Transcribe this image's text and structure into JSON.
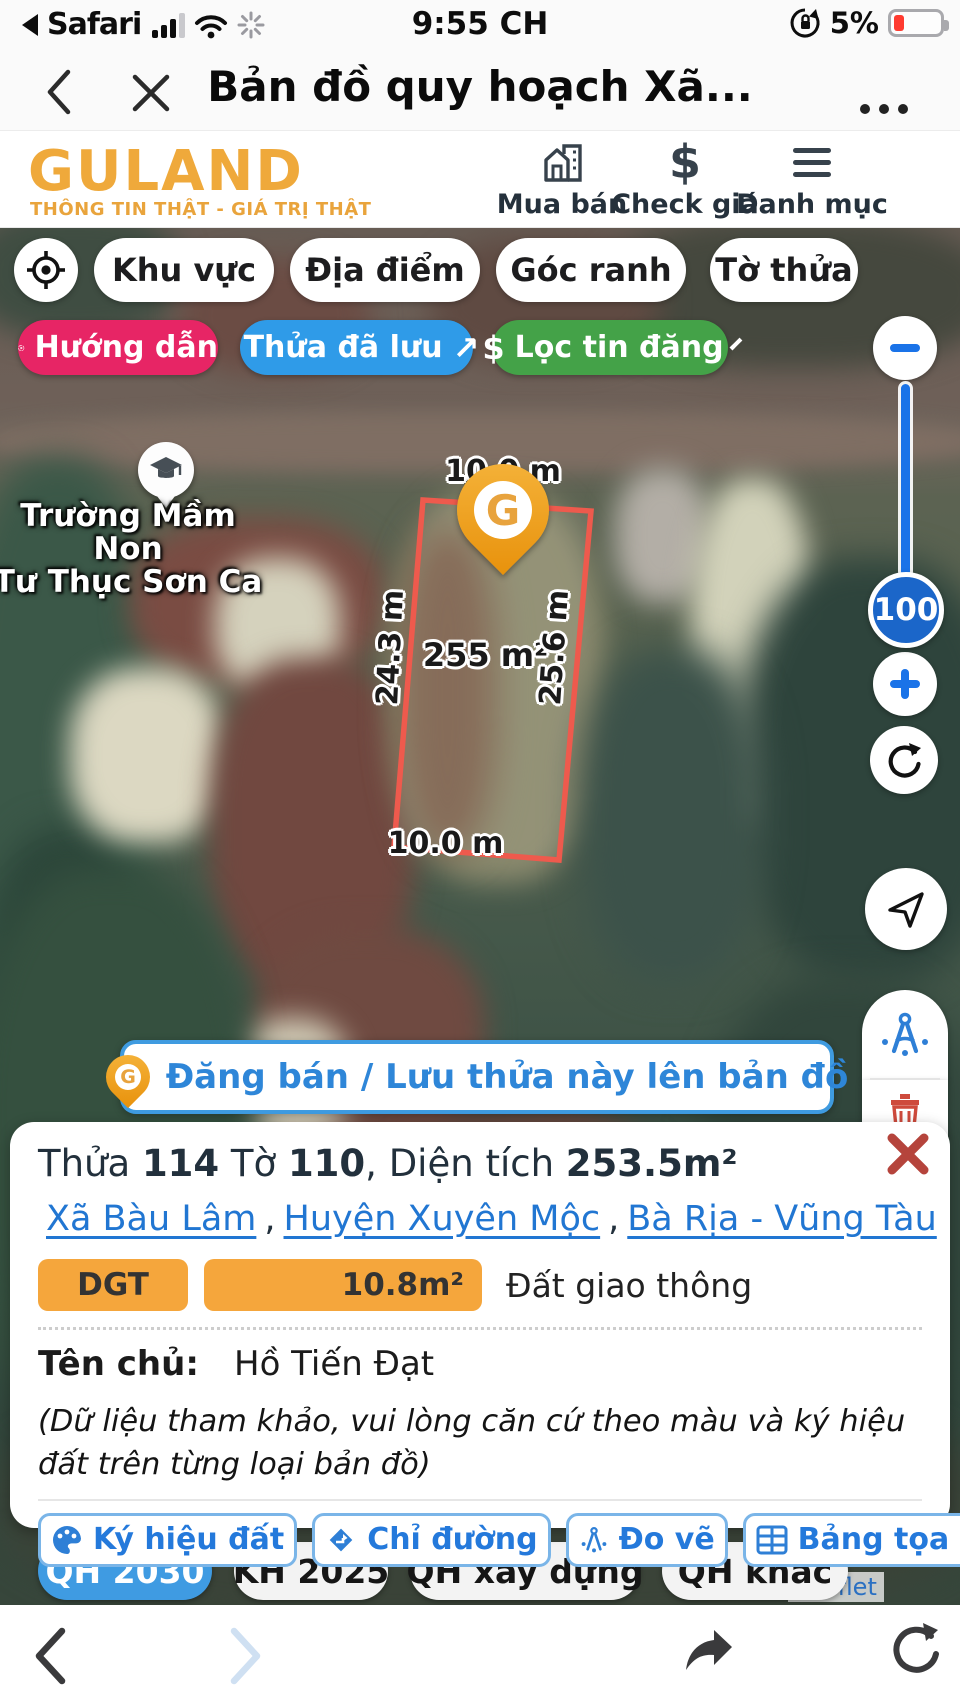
{
  "status_bar": {
    "back_app": "Safari",
    "time": "9:55 CH",
    "battery_percent": "5%"
  },
  "browser_bar": {
    "title": "Bản đồ quy hoạch Xã..."
  },
  "app_header": {
    "logo": "GULAND",
    "tagline": "THÔNG TIN THẬT - GIÁ TRỊ THẬT",
    "nav": [
      {
        "label": "Mua bán"
      },
      {
        "label": "Check giá"
      },
      {
        "label": "Danh mục"
      }
    ]
  },
  "icons": {
    "dollar": "$",
    "external_arrow": "↗"
  },
  "map_toolbar": {
    "pills": [
      {
        "label": "Khu vực"
      },
      {
        "label": "Địa điểm"
      },
      {
        "label": "Góc ranh"
      },
      {
        "label": "Tờ thửa"
      }
    ],
    "guide_label": "Hướng dẫn",
    "saved_label": "Thửa đã lưu",
    "filter_label": "Lọc tin đăng"
  },
  "map": {
    "poi_line1": "Trường Mầm Non",
    "poi_line2": "Tư Thục Sơn Ca",
    "parcel_labels": {
      "top": "10.0 m",
      "left": "24.3 m",
      "area": "255 m²",
      "right": "25.6 m",
      "bottom": "10.0 m"
    },
    "zoom_level": "100",
    "pin_letter": "G",
    "attribution": "Leaflet"
  },
  "register_button": {
    "label": "Đăng bán / Lưu thửa này lên bản đồ"
  },
  "parcel_panel": {
    "title": {
      "p1": "Thửa ",
      "p2": "114",
      "p3": " Tờ ",
      "p4": "110",
      "p5": ", Diện tích ",
      "p6": "253.5m²"
    },
    "links": [
      {
        "label": "Xã Bàu Lâm"
      },
      {
        "label": "Huyện Xuyên Mộc"
      },
      {
        "label": "Bà Rịa - Vũng Tàu"
      }
    ],
    "link_separator": ",",
    "land_use": {
      "code": "DGT",
      "area": "10.8m²",
      "name": "Đất giao thông"
    },
    "owner_label": "Tên chủ:",
    "owner_name": "Hồ Tiến Đạt",
    "note": "(Dữ liệu tham khảo, vui lòng căn cứ theo màu và ký hiệu đất trên từng loại bản đồ)",
    "actions": [
      {
        "label": "Ký hiệu đất"
      },
      {
        "label": "Chỉ đường"
      },
      {
        "label": "Đo vẽ"
      },
      {
        "label": "Bảng tọa độ"
      }
    ]
  },
  "layer_buttons": [
    {
      "label": "QH 2030",
      "active": true
    },
    {
      "label": "KH 2025",
      "active": false
    },
    {
      "label": "QH xây dựng",
      "active": false
    },
    {
      "label": "QH khác",
      "active": false
    }
  ],
  "colors": {
    "brand_gold": "#EFA93B",
    "accent_blue": "#1A73E8",
    "pill_pink": "#E72565",
    "pill_blue": "#2F9BE8",
    "pill_green": "#44A248",
    "parcel_outline": "#EE5A4D",
    "link_blue": "#2176D2",
    "badge_orange": "#F5A63C",
    "danger_red": "#B5443C",
    "active_layer_blue": "#3F9BE2"
  }
}
